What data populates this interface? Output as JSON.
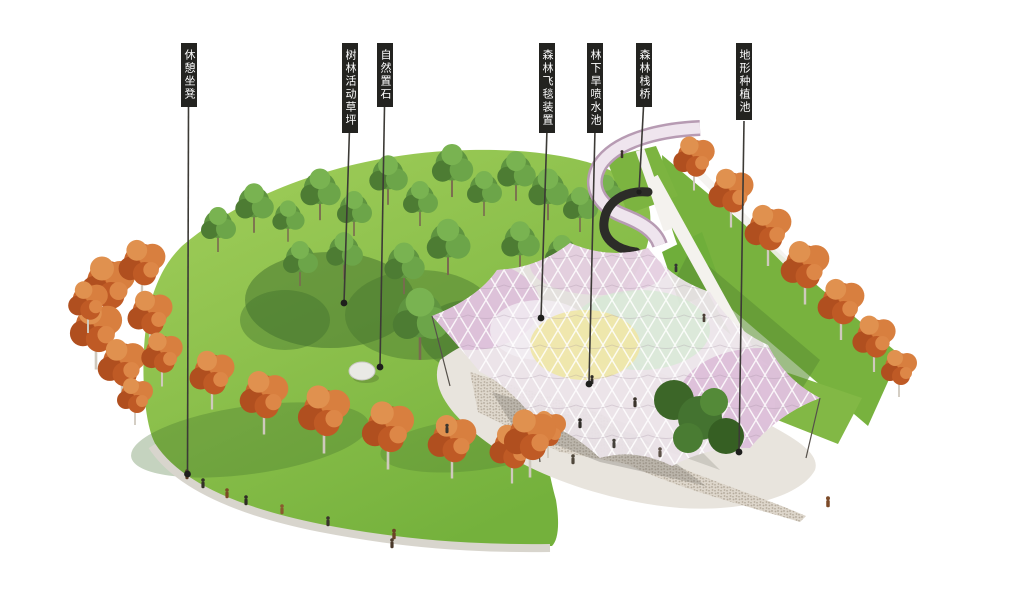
{
  "annotations": {
    "labels": [
      {
        "id": "rest-bench",
        "text": "休憩坐凳"
      },
      {
        "id": "forest-activity-lawn",
        "text": "树林活动草坪"
      },
      {
        "id": "natural-stone",
        "text": "自然置石"
      },
      {
        "id": "forest-flying-carpet",
        "text": "森林飞毯装置"
      },
      {
        "id": "understory-dry-fountain",
        "text": "林下旱喷水池"
      },
      {
        "id": "forest-boardwalk",
        "text": "森林栈桥"
      },
      {
        "id": "terrain-planting-pool",
        "text": "地形种植池"
      }
    ]
  },
  "palette": {
    "background": "#ffffff",
    "label_bg": "#232320",
    "label_text": "#ffffff",
    "leader_line": "#3c3a36",
    "lawn_light": "#9ccb55",
    "lawn_dark": "#6fae39",
    "lawn_shadow": "#3f6d2c",
    "tree_green": "#5c9440",
    "tree_green_dark": "#3e6b2b",
    "tree_autumn": "#c9662c",
    "tree_autumn_light": "#dd8747",
    "canopy_base": "#ece4ea",
    "canopy_pink": "#dcbcd8",
    "canopy_yellow": "#efe7a6",
    "canopy_mint": "#d6e9d4",
    "plaza": "#e8e4dd",
    "gravel": "#b5ab9c",
    "bench_edge": "#d8d5cd",
    "bridge_deck": "#efe5ee",
    "bridge_rail": "#b79bb3",
    "stone": "#e9e9e5"
  }
}
